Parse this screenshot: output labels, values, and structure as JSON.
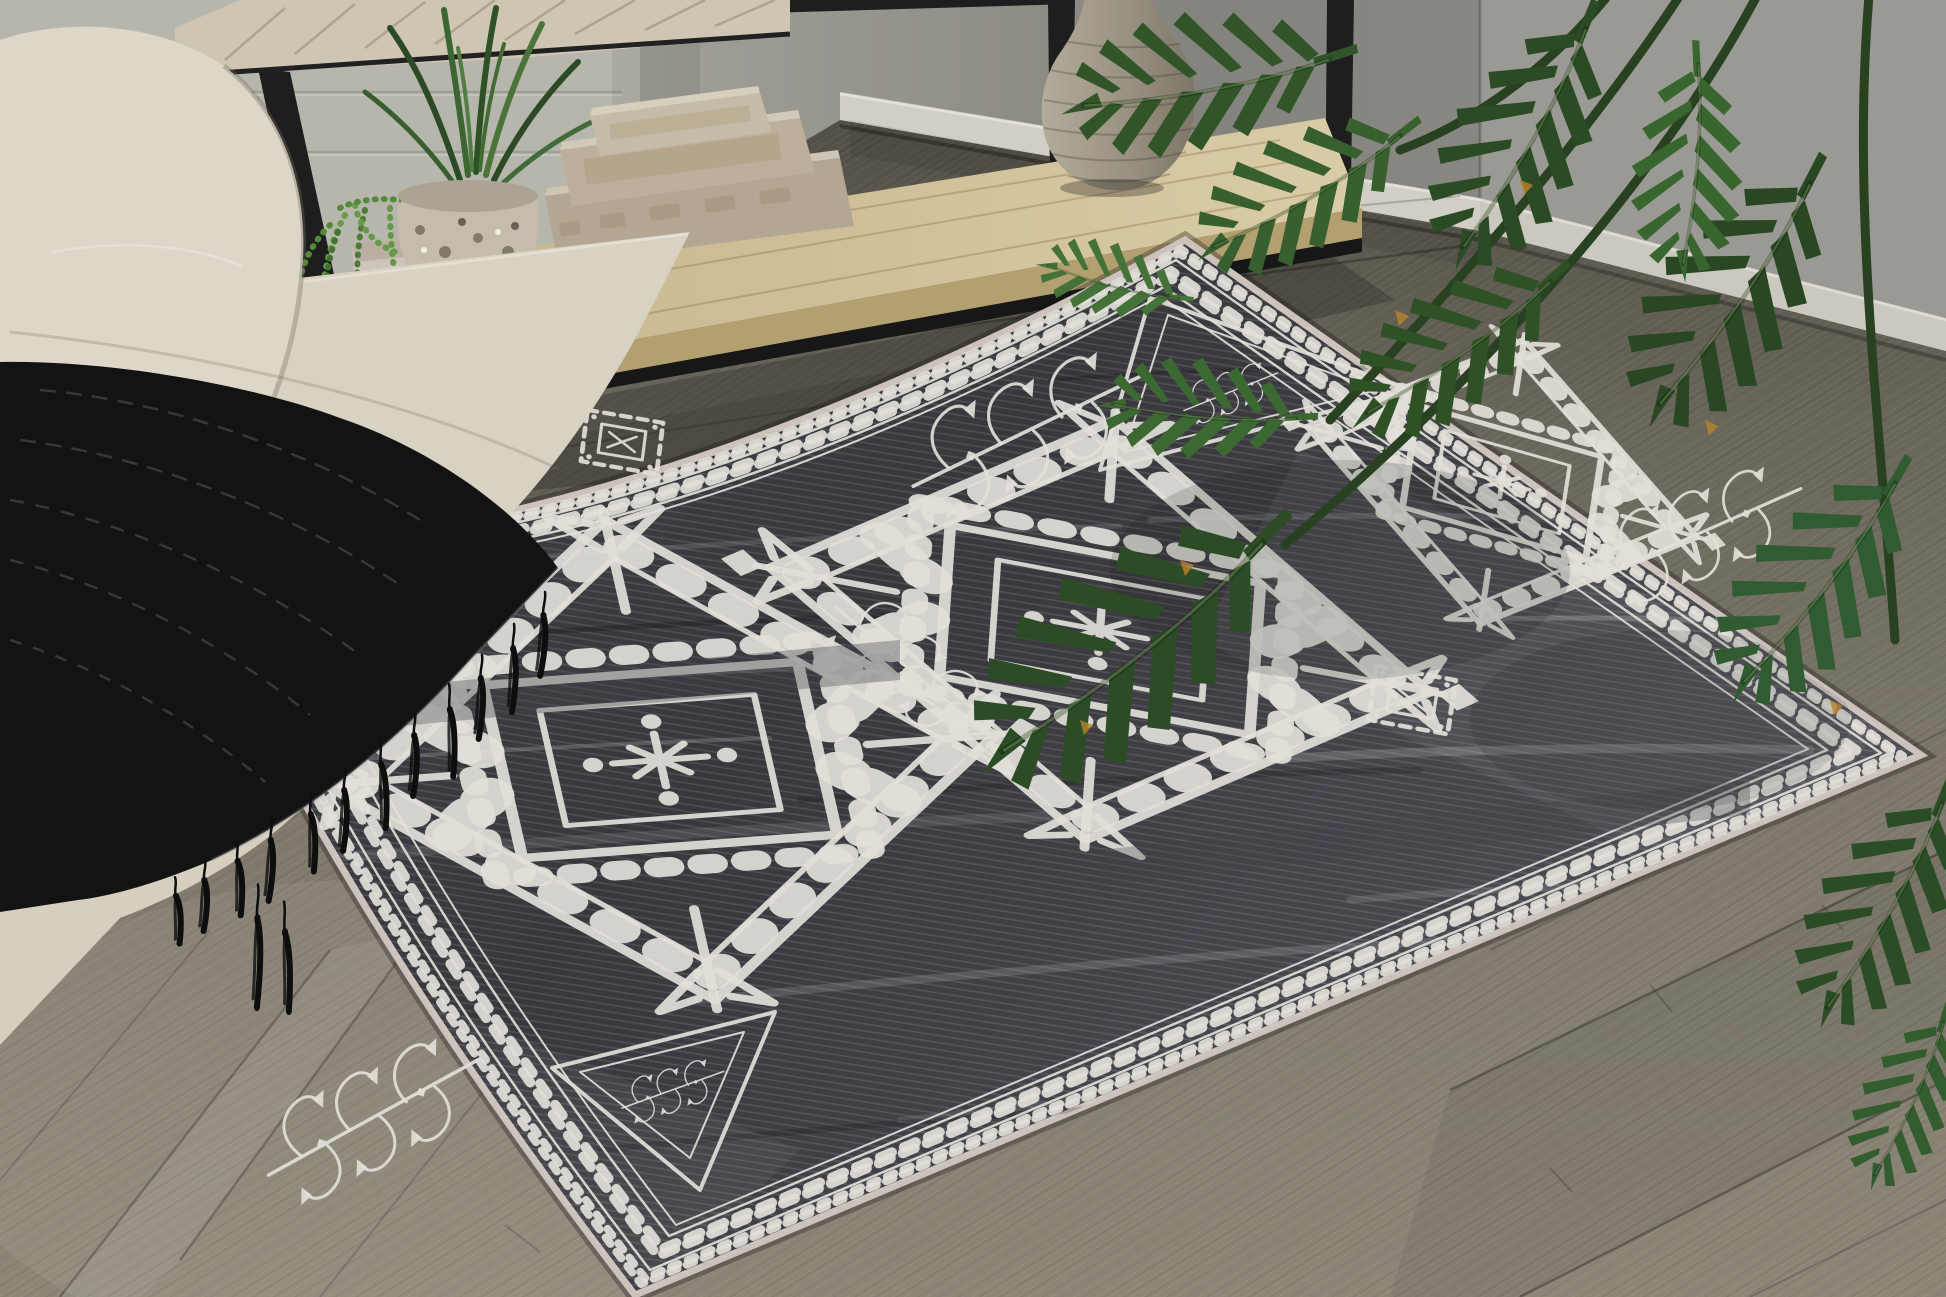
{
  "image": {
    "type": "photograph",
    "subject": "living room corner staged with a charcoal tribal-pattern area rug",
    "width_px": 1946,
    "height_px": 1297
  },
  "palette": {
    "rug_field": "#424147",
    "rug_pattern_white": "#ece9e2",
    "rug_binding": "#d6ccc6",
    "floor_wood": "#85806f",
    "floor_wood_dark": "#56534b",
    "wall_smooth": "#8f8e87",
    "wall_paneled": "#c0bfb5",
    "baseboard": "#dcd9d0",
    "sofa_fabric": "#e7e1d3",
    "throw_blanket": "#141414",
    "metal_frame": "#1f1f1f",
    "table_top_wood": "#d8cfbc",
    "shelf_wood": "#d4c094",
    "vase": "#a89f8e",
    "box_linen": "#c3b6a2",
    "plant_green": "#335829",
    "succulent_green": "#5d9340"
  },
  "objects": [
    {
      "name": "area-rug",
      "description": "charcoal gray rug with distressed white tribal pattern",
      "motifs": [
        "checkered diamond border chains",
        "corner triangles with branch glyph",
        "serrated diamond medallions",
        "stepped cross medallions",
        "curled branch motifs"
      ]
    },
    {
      "name": "sofa",
      "description": "cream textured sofa arm with black fringed throw and dotted accent pillow"
    },
    {
      "name": "console-table",
      "description": "black metal console table, whitewashed wood top, light wood lower shelf"
    },
    {
      "name": "shelf-decor",
      "items": [
        "speckled mosaic planter with grassy plant",
        "string-of-pearls succulent in small pot",
        "stack of three linen book boxes",
        "ribbed stoneware gourd vase"
      ]
    },
    {
      "name": "floor",
      "description": "gray-brown wood plank flooring laid diagonally"
    },
    {
      "name": "houseplant",
      "description": "split-leaf philodendron fronds entering from the upper right"
    }
  ]
}
